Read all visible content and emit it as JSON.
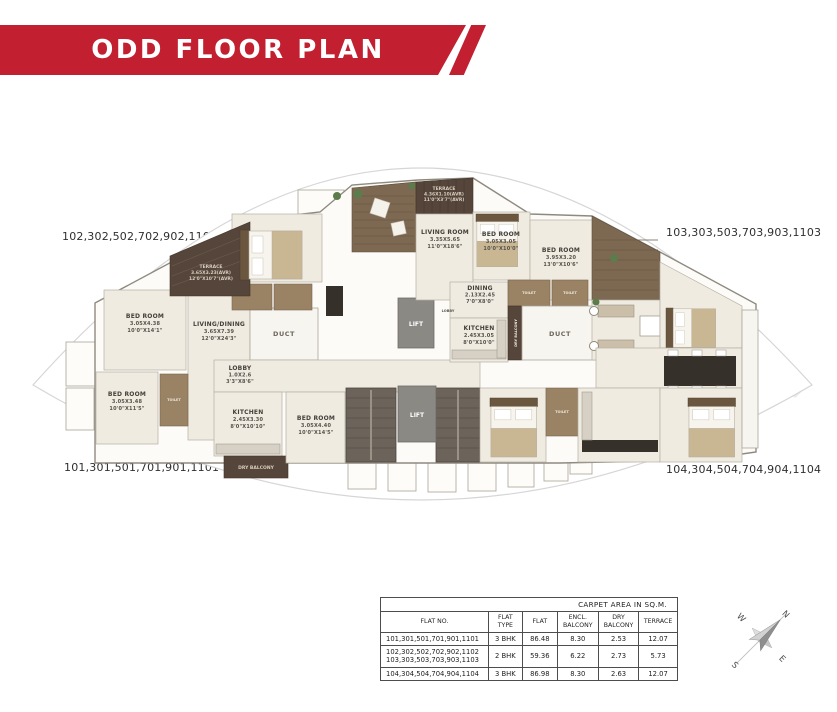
{
  "header": {
    "title": "ODD FLOOR PLAN"
  },
  "flat_groups": {
    "top_left": "102,302,502,702,902,1102",
    "top_right": "103,303,503,703,903,1103",
    "bottom_left": "101,301,501,701,901,1101",
    "bottom_right": "104,304,504,704,904,1104"
  },
  "plan": {
    "rooms": {
      "terrace_102": {
        "l1": "TERRACE",
        "l2": "3.65X3.23(AVR)",
        "l3": "12'0\"X10'7\"(AVR)"
      },
      "bed_102": {
        "l1": "BED ROOM",
        "l2": "3.05X4.38",
        "l3": "10'0\"X14'1\""
      },
      "living_dining_102": {
        "l1": "LIVING/DINING",
        "l2": "3.65X7.39",
        "l3": "12'0\"X24'3\""
      },
      "bed_101a": {
        "l1": "BED ROOM",
        "l2": "3.05X3.48",
        "l3": "10'0\"X11'5\""
      },
      "lobby_101": {
        "l1": "LOBBY",
        "l2": "1.0X2.6",
        "l3": "3'3\"X8'6\""
      },
      "kitchen_101": {
        "l1": "KITCHEN",
        "l2": "2.45X3.30",
        "l3": "8'0\"X10'10\""
      },
      "bed_101b": {
        "l1": "BED ROOM",
        "l2": "3.05X4.40",
        "l3": "10'0\"X14'5\""
      },
      "terrace_103": {
        "l1": "TERRACE",
        "l2": "4.36X1.10(AVR)",
        "l3": "11'0\"X3'7\"(AVR)"
      },
      "living_103": {
        "l1": "LIVING ROOM",
        "l2": "3.35X5.65",
        "l3": "11'0\"X18'6\""
      },
      "bed_103a": {
        "l1": "BED ROOM",
        "l2": "3.05X3.05",
        "l3": "10'0\"X10'0\""
      },
      "bed_103b": {
        "l1": "BED ROOM",
        "l2": "3.95X3.20",
        "l3": "13'0\"X10'6\""
      },
      "dining_103": {
        "l1": "DINING",
        "l2": "2.13X2.45",
        "l3": "7'0\"X8'0\""
      },
      "kitchen_103": {
        "l1": "KITCHEN",
        "l2": "2.45X3.05",
        "l3": "8'0\"X10'0\""
      },
      "dry_balcony": {
        "l1": "DRY BALCONY"
      },
      "duct": {
        "l1": "DUCT"
      },
      "lift": {
        "l1": "LIFT"
      },
      "lobby_core": {
        "l1": "LOBBY"
      },
      "toilet": {
        "l1": "TOILET"
      }
    }
  },
  "table": {
    "title": "CARPET AREA IN SQ.M.",
    "columns": [
      "FLAT NO.",
      "FLAT TYPE",
      "FLAT",
      "ENCL. BALCONY",
      "DRY BALCONY",
      "TERRACE"
    ],
    "rows": [
      {
        "flat_no": "101,301,501,701,901,1101",
        "flat_no2": "",
        "type": "3 BHK",
        "flat": "86.48",
        "encl": "8.30",
        "dry": "2.53",
        "terrace": "12.07"
      },
      {
        "flat_no": "102,302,502,702,902,1102",
        "flat_no2": "103,303,503,703,903,1103",
        "type": "2 BHK",
        "flat": "59.36",
        "encl": "6.22",
        "dry": "2.73",
        "terrace": "5.73"
      },
      {
        "flat_no": "104,304,504,704,904,1104",
        "flat_no2": "",
        "type": "3 BHK",
        "flat": "86.98",
        "encl": "8.30",
        "dry": "2.63",
        "terrace": "12.07"
      }
    ]
  },
  "compass": {
    "n": "N",
    "e": "E",
    "s": "S",
    "w": "W"
  },
  "colors": {
    "banner_red": "#c22031",
    "terrace_dark": "#55453a",
    "deck_wood": "#7d6852",
    "stair": "#6c635b",
    "lift": "#8b8984",
    "floor": "#efebe1",
    "toilet": "#9a8264"
  }
}
